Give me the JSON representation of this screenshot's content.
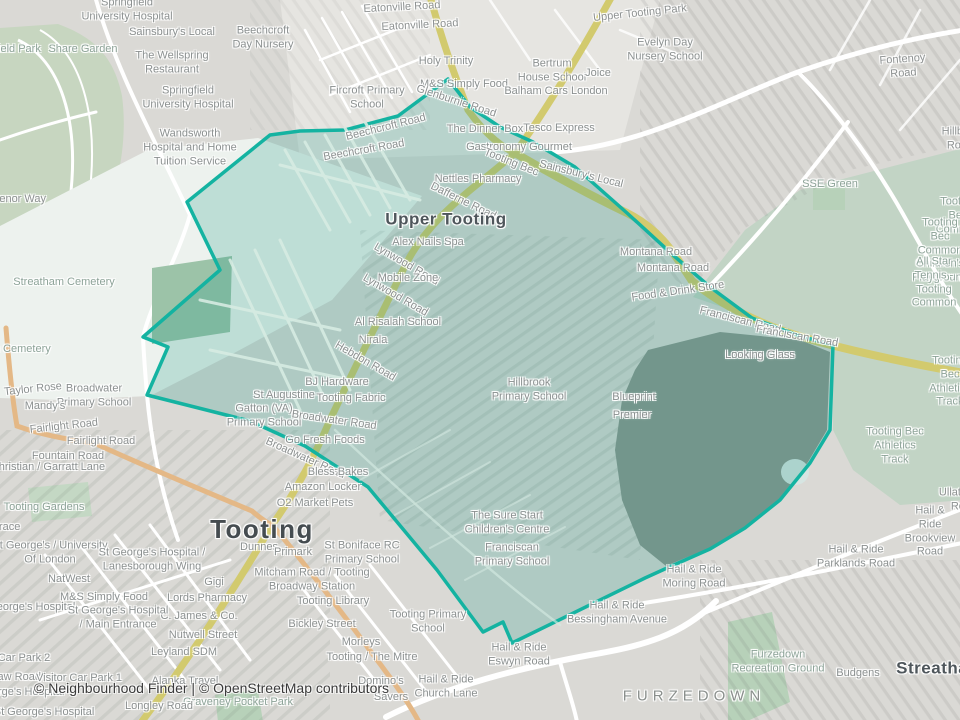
{
  "attribution": "© Neighbourhood Finder | © OpenStreetMap contributors",
  "colors": {
    "boundary_stroke": "#14b3a1",
    "boundary_fill": "rgba(22,152,132,0.22)",
    "base": "#dad9d5",
    "open_land": "#edf2ee",
    "park_green": "#c2d4c5",
    "small_green": "#b7d1b9",
    "primary_road": "#d2ca6e",
    "secondary_road": "#e4b886",
    "minor_road": "#ffffff"
  },
  "map": {
    "boundary": {
      "stroke": "#14b3a1",
      "fill": "rgba(22,152,132,0.22)",
      "points": [
        [
          448,
          79
        ],
        [
          470,
          107
        ],
        [
          500,
          127
        ],
        [
          533,
          142
        ],
        [
          575,
          167
        ],
        [
          627,
          213
        ],
        [
          673,
          255
        ],
        [
          710,
          287
        ],
        [
          752,
          318
        ],
        [
          800,
          336
        ],
        [
          833,
          345
        ],
        [
          830,
          430
        ],
        [
          810,
          463
        ],
        [
          780,
          500
        ],
        [
          745,
          528
        ],
        [
          710,
          549
        ],
        [
          667,
          568
        ],
        [
          645,
          578
        ],
        [
          512,
          643
        ],
        [
          503,
          622
        ],
        [
          483,
          632
        ],
        [
          437,
          570
        ],
        [
          368,
          487
        ],
        [
          305,
          446
        ],
        [
          250,
          421
        ],
        [
          147,
          395
        ],
        [
          168,
          347
        ],
        [
          143,
          337
        ],
        [
          220,
          270
        ],
        [
          187,
          202
        ],
        [
          270,
          135
        ],
        [
          300,
          131
        ],
        [
          345,
          130
        ],
        [
          398,
          116
        ]
      ]
    },
    "labels": [
      {
        "text": "Springfield\nUniversity Hospital",
        "x": 127,
        "y": 10,
        "type": "poi"
      },
      {
        "text": "Sainsbury's Local",
        "x": 172,
        "y": 33,
        "type": "poi"
      },
      {
        "text": "Beechcroft\nDay Nursery",
        "x": 263,
        "y": 38,
        "type": "poi"
      },
      {
        "text": "Share Garden",
        "x": 83,
        "y": 50,
        "type": "area"
      },
      {
        "text": "Springfield Park",
        "x": 2,
        "y": 50,
        "type": "area"
      },
      {
        "text": "The Wellspring\nRestaurant",
        "x": 172,
        "y": 63,
        "type": "poi"
      },
      {
        "text": "Springfield\nUniversity Hospital",
        "x": 188,
        "y": 98,
        "type": "poi"
      },
      {
        "text": "Eatonville Road",
        "x": 402,
        "y": 8,
        "type": "road",
        "rot": -3
      },
      {
        "text": "Eatonville Road",
        "x": 420,
        "y": 26,
        "type": "road",
        "rot": -3
      },
      {
        "text": "Holy Trinity",
        "x": 446,
        "y": 62,
        "type": "poi"
      },
      {
        "text": "Fircroft Primary\nSchool",
        "x": 367,
        "y": 98,
        "type": "poi"
      },
      {
        "text": "M&S Simply Food",
        "x": 464,
        "y": 85,
        "type": "poi"
      },
      {
        "text": "Glenburnie Road",
        "x": 456,
        "y": 102,
        "type": "road",
        "rot": 18
      },
      {
        "text": "Bertrum\nHouse School",
        "x": 552,
        "y": 71,
        "type": "poi"
      },
      {
        "text": "Joice",
        "x": 598,
        "y": 74,
        "type": "poi"
      },
      {
        "text": "Balham Cars London",
        "x": 556,
        "y": 92,
        "type": "poi"
      },
      {
        "text": "Upper Tooting Park",
        "x": 640,
        "y": 14,
        "type": "road",
        "rot": -6
      },
      {
        "text": "Evelyn Day\nNursery School",
        "x": 665,
        "y": 50,
        "type": "poi"
      },
      {
        "text": "Fontenoy Road",
        "x": 903,
        "y": 67,
        "type": "road",
        "rot": -4
      },
      {
        "text": "Hillbury Road",
        "x": 960,
        "y": 139,
        "type": "road"
      },
      {
        "text": "Wandsworth\nHospital and Home\nTuition Service",
        "x": 190,
        "y": 148,
        "type": "poi"
      },
      {
        "text": "Grosvenor Way",
        "x": 8,
        "y": 200,
        "type": "road"
      },
      {
        "text": "Beechcroft Road",
        "x": 386,
        "y": 128,
        "type": "road",
        "rot": -14
      },
      {
        "text": "Beechcroft Road",
        "x": 364,
        "y": 151,
        "type": "road",
        "rot": -10
      },
      {
        "text": "The Dinner Box",
        "x": 485,
        "y": 130,
        "type": "poi"
      },
      {
        "text": "Tesco Express",
        "x": 559,
        "y": 129,
        "type": "poi"
      },
      {
        "text": "Gastronomy Gourmet",
        "x": 519,
        "y": 148,
        "type": "poi"
      },
      {
        "text": "Tooting Bec",
        "x": 511,
        "y": 163,
        "type": "road",
        "rot": 22
      },
      {
        "text": "Sainsbury's Local",
        "x": 581,
        "y": 175,
        "type": "poi",
        "rot": 14
      },
      {
        "text": "Nettles Pharmacy",
        "x": 478,
        "y": 180,
        "type": "poi"
      },
      {
        "text": "SSE Green",
        "x": 830,
        "y": 185,
        "type": "area"
      },
      {
        "text": "Dafferne Road",
        "x": 463,
        "y": 202,
        "type": "road",
        "rot": 26
      },
      {
        "text": "Tooting Bec Common",
        "x": 958,
        "y": 216,
        "type": "area"
      },
      {
        "text": "Upper Tooting",
        "x": 446,
        "y": 219,
        "type": "suburb"
      },
      {
        "text": "Montana Road",
        "x": 656,
        "y": 253,
        "type": "road"
      },
      {
        "text": "Montana Road",
        "x": 673,
        "y": 269,
        "type": "road"
      },
      {
        "text": "Tooting Bec Common\nChildren's Playground",
        "x": 940,
        "y": 251,
        "type": "area"
      },
      {
        "text": "Food & Drink Store",
        "x": 678,
        "y": 292,
        "type": "poi",
        "rot": -8
      },
      {
        "text": "All Star Tennis -\nTooting Common",
        "x": 934,
        "y": 283,
        "type": "area"
      },
      {
        "text": "Alex Nails Spa",
        "x": 428,
        "y": 243,
        "type": "poi"
      },
      {
        "text": "Lynwood Road",
        "x": 406,
        "y": 265,
        "type": "road",
        "rot": 30
      },
      {
        "text": "Mobile Zone",
        "x": 408,
        "y": 279,
        "type": "poi"
      },
      {
        "text": "Lynwood Road",
        "x": 395,
        "y": 296,
        "type": "road",
        "rot": 30
      },
      {
        "text": "Streatham Cemetery",
        "x": 64,
        "y": 283,
        "type": "area"
      },
      {
        "text": "Al Risalah School",
        "x": 398,
        "y": 323,
        "type": "poi"
      },
      {
        "text": "Franciscan Road",
        "x": 740,
        "y": 321,
        "type": "road",
        "rot": 14
      },
      {
        "text": "Franciscan Road",
        "x": 797,
        "y": 337,
        "type": "road",
        "rot": 10
      },
      {
        "text": "Nirala",
        "x": 373,
        "y": 341,
        "type": "poi"
      },
      {
        "text": "Streatham Cemetery",
        "x": 0,
        "y": 350,
        "type": "area"
      },
      {
        "text": "Looking Glass",
        "x": 760,
        "y": 356,
        "type": "poi"
      },
      {
        "text": "Hebdon Road",
        "x": 365,
        "y": 362,
        "type": "road",
        "rot": 30
      },
      {
        "text": "BJ Hardware",
        "x": 337,
        "y": 383,
        "type": "poi"
      },
      {
        "text": "Tooting Bec\nAthletics Track",
        "x": 950,
        "y": 382,
        "type": "area"
      },
      {
        "text": "Taylor Rose",
        "x": 33,
        "y": 390,
        "type": "poi",
        "rot": -6
      },
      {
        "text": "St Augustine",
        "x": 284,
        "y": 396,
        "type": "poi"
      },
      {
        "text": "Broadwater\nPrimary School",
        "x": 94,
        "y": 396,
        "type": "poi"
      },
      {
        "text": "Tooting Fabric",
        "x": 351,
        "y": 399,
        "type": "poi"
      },
      {
        "text": "Blueprint",
        "x": 634,
        "y": 398,
        "type": "poi"
      },
      {
        "text": "Mandy's",
        "x": 45,
        "y": 407,
        "type": "poi"
      },
      {
        "text": "Gatton (VA)\nPrimary School",
        "x": 264,
        "y": 416,
        "type": "poi"
      },
      {
        "text": "Hillbrook\nPrimary School",
        "x": 529,
        "y": 390,
        "type": "poi"
      },
      {
        "text": "Premier",
        "x": 632,
        "y": 416,
        "type": "poi"
      },
      {
        "text": "Broadwater Road",
        "x": 334,
        "y": 421,
        "type": "road",
        "rot": 8
      },
      {
        "text": "Fairlight Road",
        "x": 64,
        "y": 427,
        "type": "road",
        "rot": -6
      },
      {
        "text": "Go Fresh Foods",
        "x": 325,
        "y": 441,
        "type": "poi"
      },
      {
        "text": "Fairlight Road",
        "x": 101,
        "y": 442,
        "type": "road"
      },
      {
        "text": "Tooting Bec\nAthletics Track",
        "x": 895,
        "y": 446,
        "type": "area"
      },
      {
        "text": "Fountain Road",
        "x": 68,
        "y": 457,
        "type": "road"
      },
      {
        "text": "Broadwater Road",
        "x": 305,
        "y": 459,
        "type": "road",
        "rot": 24
      },
      {
        "text": "Christian / Garratt Lane",
        "x": 48,
        "y": 468,
        "type": "poi"
      },
      {
        "text": "Bless Bakes",
        "x": 338,
        "y": 473,
        "type": "poi"
      },
      {
        "text": "Amazon Locker",
        "x": 323,
        "y": 488,
        "type": "poi"
      },
      {
        "text": "Ullathorne Road",
        "x": 964,
        "y": 500,
        "type": "road"
      },
      {
        "text": "O2 Market Pets",
        "x": 315,
        "y": 504,
        "type": "poi"
      },
      {
        "text": "Tooting Gardens",
        "x": 44,
        "y": 508,
        "type": "area"
      },
      {
        "text": "The Sure Start\nChildren's Centre",
        "x": 507,
        "y": 523,
        "type": "poi"
      },
      {
        "text": "Hail & Ride\nBrookview Road",
        "x": 930,
        "y": 532,
        "type": "poi"
      },
      {
        "text": "Terrace",
        "x": 2,
        "y": 528,
        "type": "road"
      },
      {
        "text": "Tooting",
        "x": 262,
        "y": 529,
        "type": "city"
      },
      {
        "text": "Dunnes",
        "x": 259,
        "y": 548,
        "type": "poi"
      },
      {
        "text": "Primark",
        "x": 293,
        "y": 553,
        "type": "poi"
      },
      {
        "text": "St Boniface RC\nPrimary School",
        "x": 362,
        "y": 553,
        "type": "poi"
      },
      {
        "text": "Franciscan\nPrimary School",
        "x": 512,
        "y": 555,
        "type": "poi"
      },
      {
        "text": "St George's / University\nOf London",
        "x": 50,
        "y": 553,
        "type": "poi"
      },
      {
        "text": "Hail & Ride\nParklands Road",
        "x": 856,
        "y": 557,
        "type": "poi"
      },
      {
        "text": "St George's Hospital /\nLanesborough Wing",
        "x": 152,
        "y": 560,
        "type": "poi"
      },
      {
        "text": "Hail & Ride\nMoring Road",
        "x": 694,
        "y": 577,
        "type": "poi"
      },
      {
        "text": "Mitcham Road / Tooting\nBroadway Station",
        "x": 312,
        "y": 580,
        "type": "poi"
      },
      {
        "text": "NatWest",
        "x": 69,
        "y": 580,
        "type": "poi"
      },
      {
        "text": "Gigi",
        "x": 214,
        "y": 583,
        "type": "poi"
      },
      {
        "text": "M&S Simply Food",
        "x": 104,
        "y": 598,
        "type": "poi"
      },
      {
        "text": "Lords Pharmacy",
        "x": 207,
        "y": 599,
        "type": "poi"
      },
      {
        "text": "Tooting Library",
        "x": 333,
        "y": 602,
        "type": "poi"
      },
      {
        "text": "St George's Hospital",
        "x": 25,
        "y": 608,
        "type": "poi"
      },
      {
        "text": "Hail & Ride\nBessingham Avenue",
        "x": 617,
        "y": 613,
        "type": "poi"
      },
      {
        "text": "C. James & Co.",
        "x": 199,
        "y": 617,
        "type": "poi"
      },
      {
        "text": "St George's Hospital\n/ Main Entrance",
        "x": 118,
        "y": 618,
        "type": "poi"
      },
      {
        "text": "Tooting Primary\nSchool",
        "x": 428,
        "y": 622,
        "type": "poi"
      },
      {
        "text": "Bickley Street",
        "x": 322,
        "y": 625,
        "type": "road"
      },
      {
        "text": "Nutwell Street",
        "x": 203,
        "y": 636,
        "type": "road"
      },
      {
        "text": "Morleys",
        "x": 361,
        "y": 643,
        "type": "poi"
      },
      {
        "text": "Leyland SDM",
        "x": 184,
        "y": 653,
        "type": "poi"
      },
      {
        "text": "Hail & Ride\nEswyn Road",
        "x": 519,
        "y": 655,
        "type": "poi"
      },
      {
        "text": "Tooting / The Mitre",
        "x": 372,
        "y": 658,
        "type": "poi"
      },
      {
        "text": "Car Park 2",
        "x": 24,
        "y": 659,
        "type": "poi"
      },
      {
        "text": "Streatham",
        "x": 940,
        "y": 668,
        "type": "town"
      },
      {
        "text": "Furzedown\nRecreation Ground",
        "x": 778,
        "y": 662,
        "type": "area"
      },
      {
        "text": "Budgens",
        "x": 858,
        "y": 674,
        "type": "poi"
      },
      {
        "text": "Blackshaw Road",
        "x": 0,
        "y": 678,
        "type": "road"
      },
      {
        "text": "Visitor Car Park 1",
        "x": 79,
        "y": 679,
        "type": "poi"
      },
      {
        "text": "Domino's",
        "x": 381,
        "y": 682,
        "type": "poi"
      },
      {
        "text": "Alanka Travel",
        "x": 185,
        "y": 682,
        "type": "poi"
      },
      {
        "text": "Hail & Ride\nChurch Lane",
        "x": 446,
        "y": 687,
        "type": "poi"
      },
      {
        "text": "FURZEDOWN",
        "x": 694,
        "y": 697,
        "type": "district"
      },
      {
        "text": "Savers",
        "x": 391,
        "y": 698,
        "type": "poi"
      },
      {
        "text": "St George's Hospital",
        "x": 14,
        "y": 693,
        "type": "poi"
      },
      {
        "text": "Graveney Pocket Park",
        "x": 238,
        "y": 703,
        "type": "area"
      },
      {
        "text": "Longley Road",
        "x": 159,
        "y": 707,
        "type": "road"
      },
      {
        "text": "St George's Hospital",
        "x": 44,
        "y": 713,
        "type": "poi"
      }
    ]
  }
}
